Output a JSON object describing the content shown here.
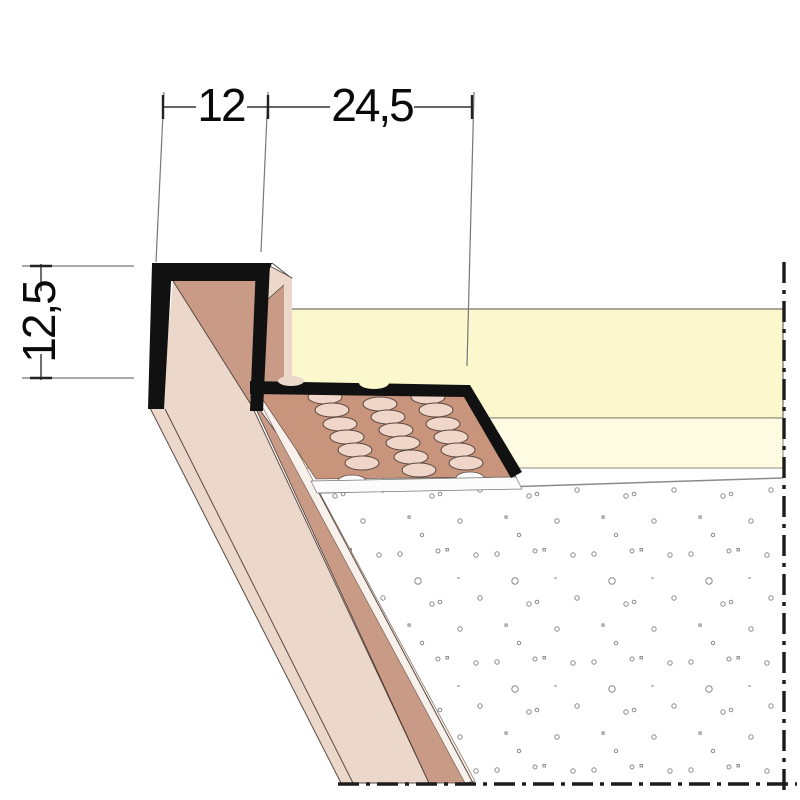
{
  "drawing": {
    "type": "technical-profile-cross-section",
    "dimensions": {
      "top_width_channel": "12",
      "top_width_flange": "24,5",
      "left_height": "12,5"
    },
    "colors": {
      "profile_black": "#111111",
      "metal_light": "#ECD8CB",
      "metal_shade": "#C99A85",
      "flange_brown": "#C9947C",
      "hole_fill": "#EFD6C9",
      "board_core_yellow": "#FBF8CE",
      "board_face_yellow": "#FDFBE2",
      "plaster_white": "#FFFFFF",
      "speckle_gray": "#8a8a8a",
      "edge_highlight": "#F8F0EA"
    }
  }
}
